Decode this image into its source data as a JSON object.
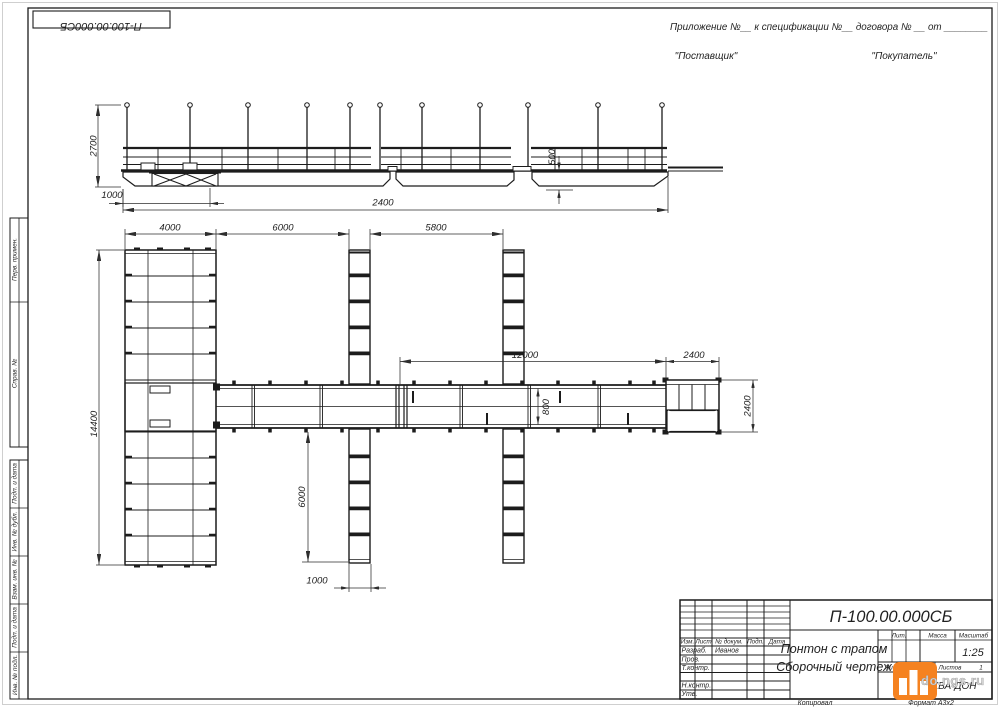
{
  "doc": {
    "number": "П-100.00.000СБ",
    "title_line1": "Понтон с трапом",
    "title_line2": "Сборочный чертеж",
    "scale_value": "1:25",
    "format_label": "Формат  А3х2"
  },
  "header": {
    "appendix_line": "Приложение №__    к спецификации №__   договора № __   от ________",
    "supplier": "\"Поставщик\"",
    "buyer": "\"Покупатель\""
  },
  "side_strip": {
    "labels": [
      "Перв. примен.",
      "Справ. №",
      "Подп. и дата",
      "Инв. № дубл.",
      "Взам. инв. №",
      "Подп. и дата",
      "Инв. № подл."
    ]
  },
  "dims": {
    "elev_post_height": "2700",
    "elev_offset": "1000",
    "elev_freeboard": "500",
    "elev_length": "2400",
    "pontoon_width": "4000",
    "bay1": "6000",
    "bay2": "5800",
    "pontoon_length": "14400",
    "walkway_length": "12000",
    "platform_width": "2400",
    "walkway_width": "800",
    "platform_depth": "2400",
    "finger_length": "6000",
    "finger_width": "1000"
  },
  "title_block": {
    "header_cols": [
      "Изм.",
      "Лист",
      "№ докум.",
      "Подп.",
      "Дата"
    ],
    "rows": [
      {
        "label": "Разраб.",
        "value": "Иванов"
      },
      {
        "label": "Пров.",
        "value": ""
      },
      {
        "label": "Т.контр.",
        "value": ""
      },
      {
        "label": "",
        "value": ""
      },
      {
        "label": "Н.контр.",
        "value": ""
      },
      {
        "label": "Утв.",
        "value": ""
      }
    ],
    "lit_label": "Лит.",
    "mass_label": "Масса",
    "scale_label": "Масштаб",
    "sheet_label": "Лист",
    "sheets_label": "Листов",
    "sheets_value": "1",
    "company": "ООО АКВА-ДОН",
    "copied_label": "Копировал"
  },
  "watermark": {
    "text": "do.ngs.ru",
    "accent": "#f58220"
  }
}
